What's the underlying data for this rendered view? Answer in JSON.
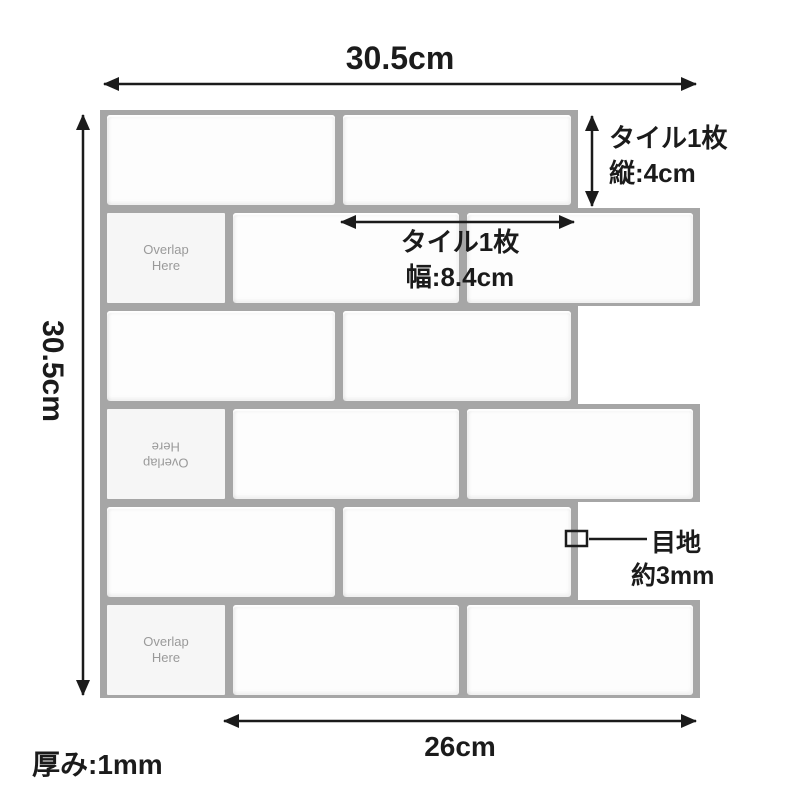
{
  "diagram_title": "tile-sheet-dimension-diagram",
  "labels": {
    "sheet_width": "30.5cm",
    "sheet_height": "30.5cm",
    "tile_height": [
      "タイル1枚",
      "縦:4cm"
    ],
    "tile_width": [
      "タイル1枚",
      "幅:8.4cm"
    ],
    "joint": [
      "目地",
      "約3mm"
    ],
    "partial_width": "26cm",
    "thickness": "厚み:1mm",
    "overlap": [
      "Overlap",
      "Here"
    ]
  },
  "colors": {
    "grout": "#a6a6a6",
    "tile": "#fdfdfd",
    "overlap_tile": "#f6f6f6",
    "overlap_text": "#9a9a9a",
    "ink": "#1b1b1b",
    "page": "#ffffff"
  },
  "sheet": {
    "rows": [
      {
        "width": 478,
        "tiles": [
          {
            "w": 228
          },
          {
            "w": 228
          }
        ]
      },
      {
        "width": 600,
        "tiles": [
          {
            "w": 118,
            "overlap": "normal"
          },
          {
            "w": 226
          },
          {
            "w": 226
          }
        ]
      },
      {
        "width": 478,
        "tiles": [
          {
            "w": 228
          },
          {
            "w": 228
          }
        ]
      },
      {
        "width": 600,
        "tiles": [
          {
            "w": 118,
            "overlap": "flipped"
          },
          {
            "w": 226
          },
          {
            "w": 226
          }
        ]
      },
      {
        "width": 478,
        "tiles": [
          {
            "w": 228
          },
          {
            "w": 228
          }
        ]
      },
      {
        "width": 600,
        "tiles": [
          {
            "w": 118,
            "overlap": "normal"
          },
          {
            "w": 226
          },
          {
            "w": 226
          }
        ]
      }
    ]
  }
}
